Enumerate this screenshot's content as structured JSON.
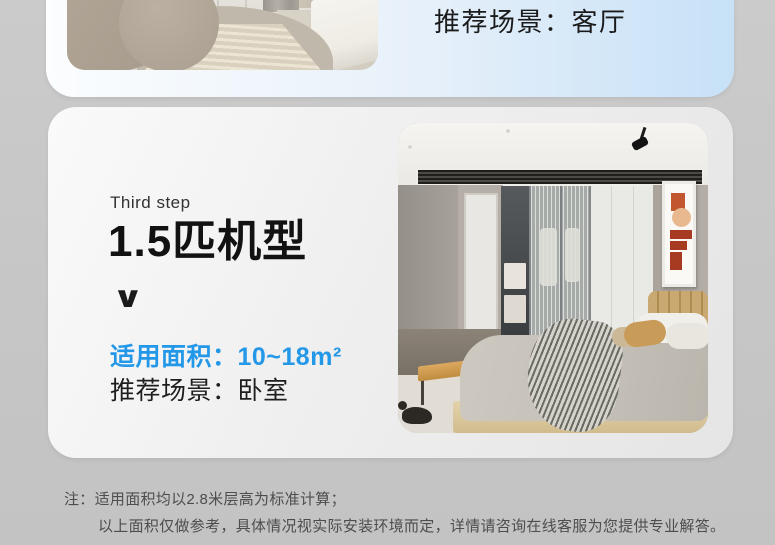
{
  "page": {
    "background_color": "#c6c6c6"
  },
  "top_card": {
    "scene_label": "推荐场景：客厅",
    "gradient_left": "#fbfdfe",
    "gradient_right": "#c7e1f7"
  },
  "model_card": {
    "step_label": "Third step",
    "title": "1.5匹机型",
    "chevron": "∨",
    "area_label": "适用面积：10~18m²",
    "scene_label": "推荐场景：卧室",
    "accent_blue": "#2398e8"
  },
  "footnote": {
    "prefix": "注：",
    "line1": "适用面积均以2.8米层高为标准计算；",
    "line2": "以上面积仅做参考，具体情况视实际安装环境而定，详情请咨询在线客服为您提供专业解答。"
  }
}
